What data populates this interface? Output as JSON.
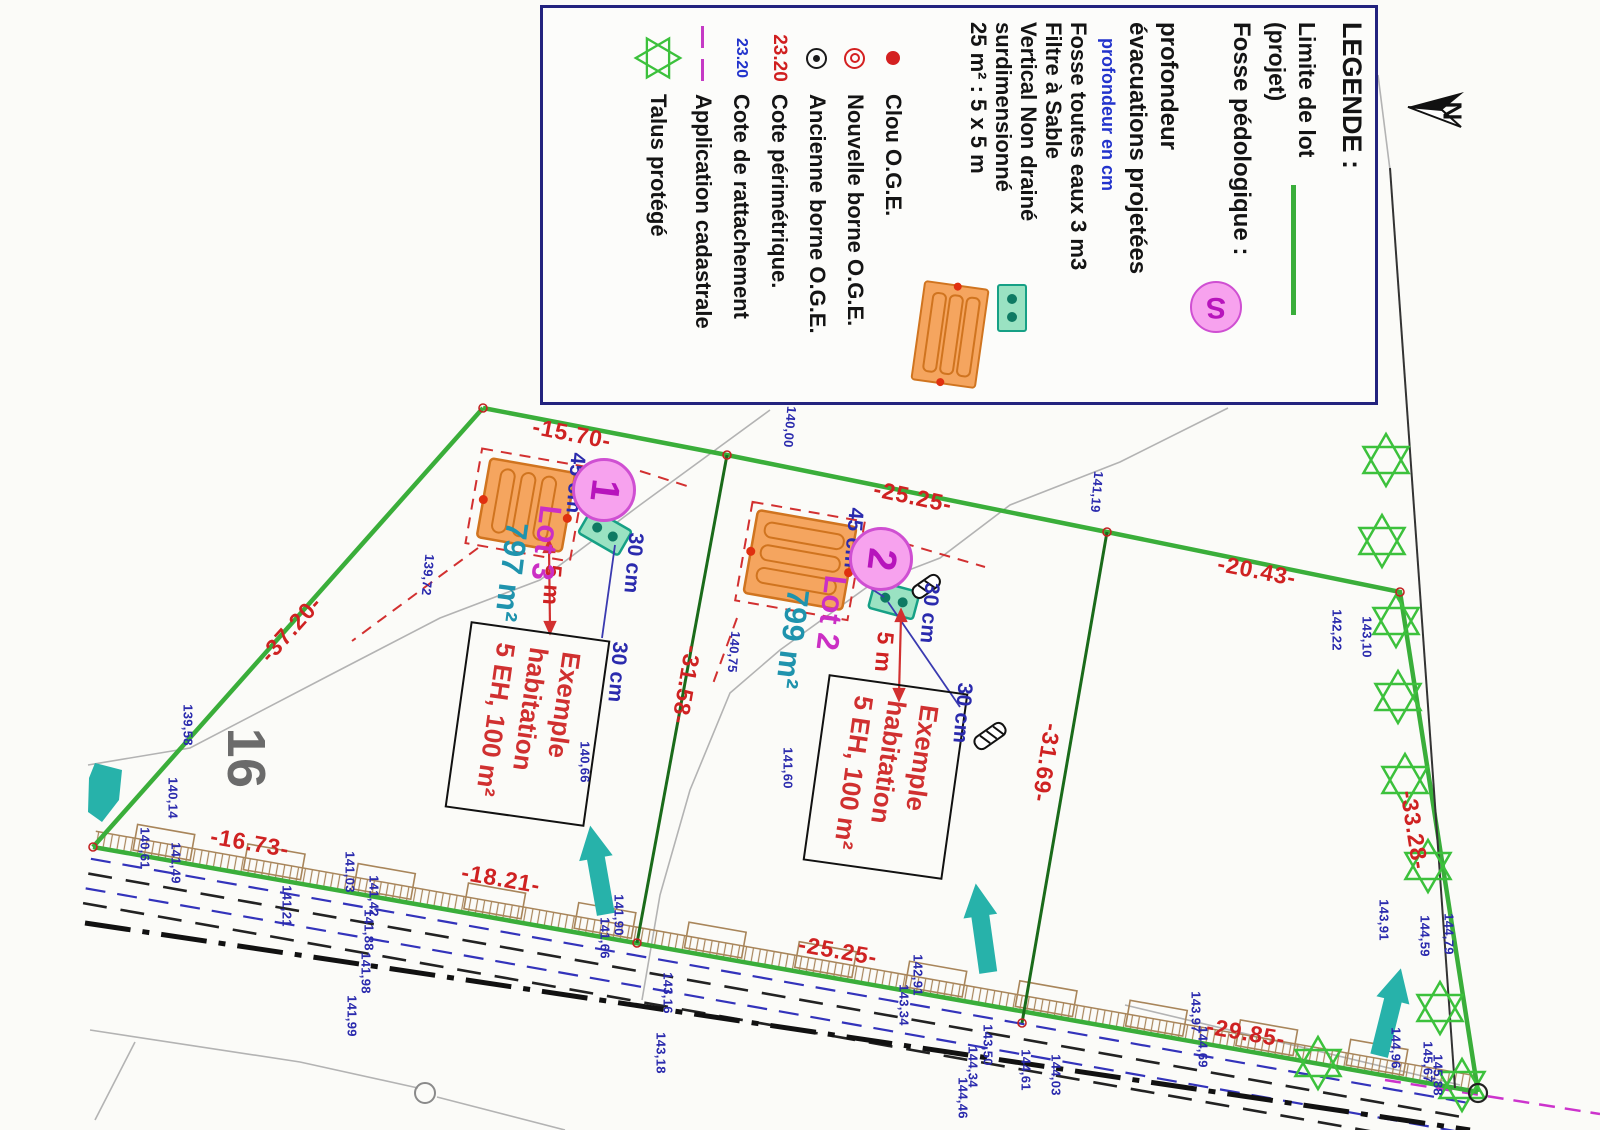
{
  "legend": {
    "title": "LEGENDE :",
    "limite_line1": "Limite de lot",
    "limite_line2": "(projet)",
    "fosse_pedo_label": "Fosse pédologique :",
    "fosse_pedo_symbol": "S",
    "prof_line1": "profondeur",
    "prof_line2": "évacuations projetées",
    "prof_note": "profondeur en cm",
    "fosse_eaux_lines": [
      "Fosse toutes eaux 3 m3",
      "Filtre à Sable",
      "Vertical Non drainé",
      "surdimensionné",
      "25 m² : 5 x 5 m"
    ],
    "clou": "Clou O.G.E.",
    "nouvelle_borne": "Nouvelle borne O.G.E.",
    "ancienne_borne": "Ancienne borne O.G.E.",
    "cote_perimetrique_value": "23.20",
    "cote_perimetrique_label": "Cote périmétrique.",
    "cote_rattachement_value": "23.20",
    "cote_rattachement_label": "Cote de rattachement",
    "application_label": "Application cadastrale",
    "talus_label": "Talus protégé"
  },
  "north_label": "N",
  "parcel_number": "16",
  "lots": [
    {
      "number": "1",
      "name": "Lot 3",
      "area": "797 m²"
    },
    {
      "number": "2",
      "name": "Lot 2",
      "area": "799 m²"
    }
  ],
  "exemple_lines": [
    "Exemple",
    "habitation",
    "5 EH, 100 m²"
  ],
  "setback_labels": [
    {
      "t": "45 cm",
      "x": 575,
      "y": 483,
      "r": 95,
      "s": 21,
      "c": "#2a2aad"
    },
    {
      "t": "45 cm",
      "x": 853,
      "y": 538,
      "r": 95,
      "s": 21,
      "c": "#2a2aad"
    },
    {
      "t": "30 cm",
      "x": 633,
      "y": 563,
      "r": 95,
      "s": 21,
      "c": "#2a2aad"
    },
    {
      "t": "30 cm",
      "x": 617,
      "y": 672,
      "r": 95,
      "s": 21,
      "c": "#2a2aad"
    },
    {
      "t": "30 cm",
      "x": 929,
      "y": 613,
      "r": 95,
      "s": 21,
      "c": "#2a2aad"
    },
    {
      "t": "30 cm",
      "x": 962,
      "y": 713,
      "r": 95,
      "s": 21,
      "c": "#2a2aad"
    },
    {
      "t": "5 m",
      "x": 552,
      "y": 585,
      "r": 95,
      "s": 23,
      "c": "#cf2222"
    },
    {
      "t": "5 m",
      "x": 884,
      "y": 652,
      "r": 95,
      "s": 23,
      "c": "#cf2222"
    }
  ],
  "dimensions": [
    {
      "t": "-15.70-",
      "x": 572,
      "y": 434,
      "r": 11
    },
    {
      "t": "-25.25-",
      "x": 913,
      "y": 497,
      "r": 12
    },
    {
      "t": "-20.43-",
      "x": 1257,
      "y": 571,
      "r": 11
    },
    {
      "t": "-37.20-",
      "x": 291,
      "y": 629,
      "r": -48
    },
    {
      "t": "-31.58-",
      "x": 686,
      "y": 685,
      "r": 100
    },
    {
      "t": "-31.69-",
      "x": 1046,
      "y": 763,
      "r": 99
    },
    {
      "t": "-33.28-",
      "x": 1414,
      "y": 830,
      "r": 81
    },
    {
      "t": "-16.73-",
      "x": 250,
      "y": 843,
      "r": 10
    },
    {
      "t": "-18.21-",
      "x": 501,
      "y": 879,
      "r": 10
    },
    {
      "t": "-25.25-",
      "x": 838,
      "y": 951,
      "r": 10
    },
    {
      "t": "-29.85-",
      "x": 1246,
      "y": 1033,
      "r": 10
    }
  ],
  "elevations": [
    {
      "t": "140,00",
      "x": 790,
      "y": 427,
      "r": 95
    },
    {
      "t": "141,19",
      "x": 1097,
      "y": 492,
      "r": 95
    },
    {
      "t": "139,72",
      "x": 428,
      "y": 575,
      "r": 95
    },
    {
      "t": "140,75",
      "x": 734,
      "y": 652,
      "r": 95
    },
    {
      "t": "141,60",
      "x": 788,
      "y": 768,
      "r": 90
    },
    {
      "t": "142,22",
      "x": 1337,
      "y": 630,
      "r": 90
    },
    {
      "t": "143,10",
      "x": 1367,
      "y": 637,
      "r": 90
    },
    {
      "t": "139,58",
      "x": 188,
      "y": 725,
      "r": 90
    },
    {
      "t": "140,14",
      "x": 173,
      "y": 798,
      "r": 90
    },
    {
      "t": "140,61",
      "x": 145,
      "y": 848,
      "r": 90
    },
    {
      "t": "141,49",
      "x": 176,
      "y": 863,
      "r": 90
    },
    {
      "t": "141,21",
      "x": 287,
      "y": 906,
      "r": 90
    },
    {
      "t": "141,03",
      "x": 350,
      "y": 872,
      "r": 90
    },
    {
      "t": "141,42",
      "x": 374,
      "y": 896,
      "r": 90
    },
    {
      "t": "141,88",
      "x": 369,
      "y": 930,
      "r": 90
    },
    {
      "t": "141,98",
      "x": 366,
      "y": 973,
      "r": 90
    },
    {
      "t": "141,99",
      "x": 352,
      "y": 1016,
      "r": 90
    },
    {
      "t": "141,90",
      "x": 619,
      "y": 915,
      "r": 90
    },
    {
      "t": "141,66",
      "x": 605,
      "y": 938,
      "r": 90
    },
    {
      "t": "143,16",
      "x": 668,
      "y": 993,
      "r": 90
    },
    {
      "t": "143,18",
      "x": 661,
      "y": 1053,
      "r": 90
    },
    {
      "t": "140,66",
      "x": 585,
      "y": 762,
      "r": 90
    },
    {
      "t": "142,91",
      "x": 918,
      "y": 975,
      "r": 90
    },
    {
      "t": "143,34",
      "x": 904,
      "y": 1005,
      "r": 90
    },
    {
      "t": "143,50",
      "x": 988,
      "y": 1045,
      "r": 90
    },
    {
      "t": "144,34",
      "x": 973,
      "y": 1067,
      "r": 90
    },
    {
      "t": "144,46",
      "x": 963,
      "y": 1098,
      "r": 90
    },
    {
      "t": "144,61",
      "x": 1026,
      "y": 1070,
      "r": 90
    },
    {
      "t": "144,03",
      "x": 1056,
      "y": 1075,
      "r": 90
    },
    {
      "t": "143,97",
      "x": 1196,
      "y": 1012,
      "r": 90
    },
    {
      "t": "144,69",
      "x": 1203,
      "y": 1047,
      "r": 90
    },
    {
      "t": "143,91",
      "x": 1384,
      "y": 920,
      "r": 90
    },
    {
      "t": "144,59",
      "x": 1425,
      "y": 936,
      "r": 90
    },
    {
      "t": "144,79",
      "x": 1449,
      "y": 934,
      "r": 90
    },
    {
      "t": "145,67",
      "x": 1428,
      "y": 1062,
      "r": 90
    },
    {
      "t": "145,88",
      "x": 1438,
      "y": 1075,
      "r": 90
    },
    {
      "t": "144,96",
      "x": 1396,
      "y": 1048,
      "r": 90
    }
  ]
}
